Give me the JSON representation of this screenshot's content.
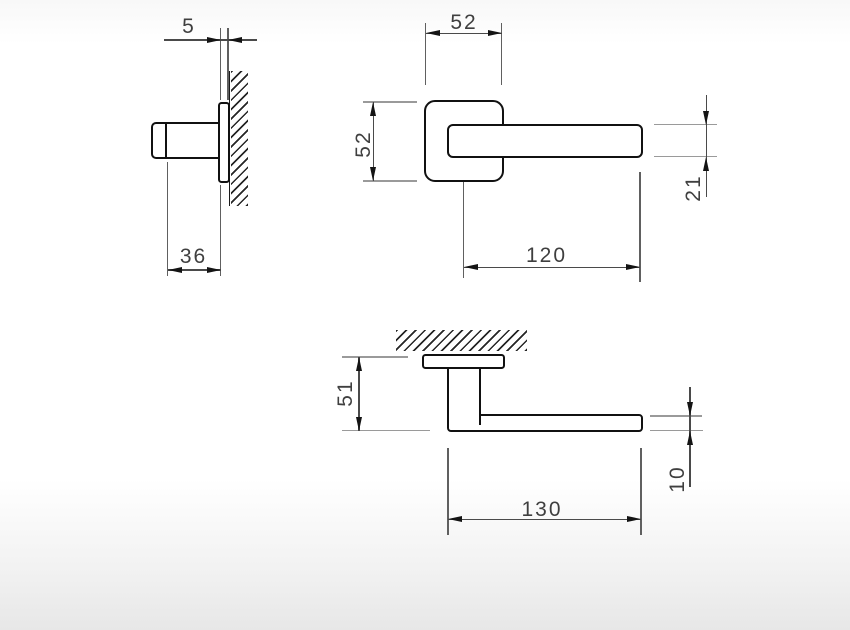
{
  "drawing": {
    "dimensions": {
      "rosette_thickness": "5",
      "rosette_depth": "36",
      "rosette_width": "52",
      "rosette_height": "52",
      "lever_length": "120",
      "lever_height": "21",
      "handle_height": "51",
      "handle_length": "130",
      "lever_thickness": "10"
    },
    "colors": {
      "object_line": "#111111",
      "dimension_line": "#4a4a4a",
      "extension_line_gray": "#9a9a9a",
      "hatch_line": "#262626",
      "text": "#3f3f3f",
      "background_fade": "#e7e7e7"
    }
  }
}
